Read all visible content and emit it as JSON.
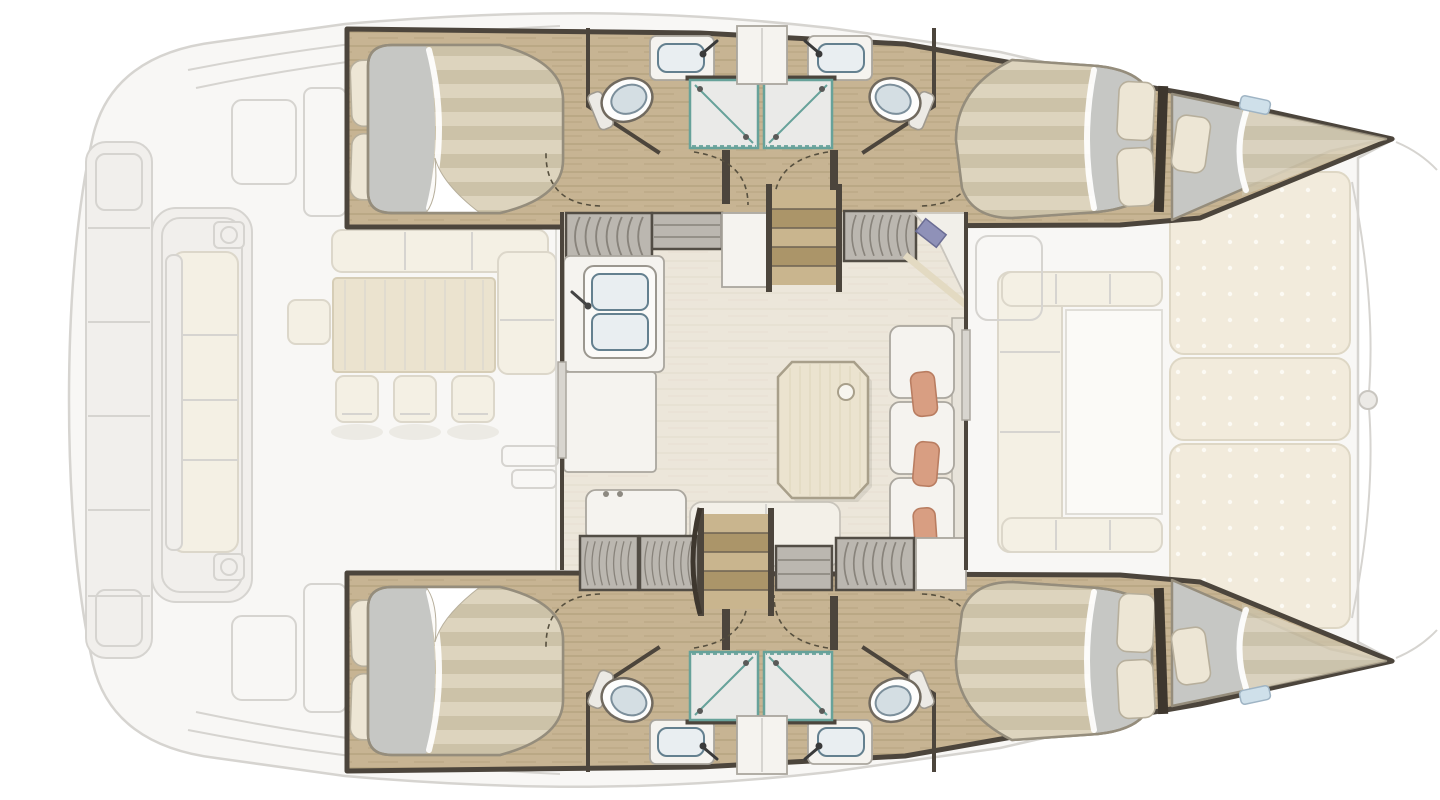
{
  "page": {
    "title": "Catamaran accommodation layout plan (top-down view)",
    "background": "#ffffff"
  },
  "diagram": {
    "type": "floor-plan",
    "subject": "sailing catamaran, deck and accommodation plan",
    "zones": {
      "aft_cockpit": {
        "label": "aft cockpit",
        "items": [
          "transom bench with cushions",
          "L-shaped bench",
          "dining table",
          "4 chairs",
          "swim platform"
        ]
      },
      "saloon": {
        "label": "saloon and galley",
        "items": [
          "double galley sink with faucet",
          "galley counter",
          "appliance unit",
          "chart table with plotter screen",
          "saloon table with cup recess",
          "L-shaped sofa with 3 salmon cushions",
          "bench seat",
          "hanging lockers",
          "companionway stairs to each hull"
        ]
      },
      "starboard_hull": {
        "label": "upper hull",
        "items": [
          "aft double cabin with 2 pillows",
          "toilet",
          "washbasin with faucet",
          "2 shower cabins",
          "forward double cabin with 2 pillows",
          "forepeak berth with pillow",
          "door swing arcs"
        ]
      },
      "port_hull": {
        "label": "lower hull (mirror of upper hull)",
        "items": [
          "aft double cabin with 2 pillows",
          "toilet",
          "washbasin with faucet",
          "2 shower cabins",
          "forward double cabin with 2 pillows",
          "forepeak berth with pillow",
          "door swing arcs"
        ]
      },
      "foredeck": {
        "label": "foredeck",
        "items": [
          "U-shaped forward cockpit seating",
          "3 sunpad cushions with button dots",
          "bow crossbeam fitting"
        ]
      }
    }
  },
  "colors": {
    "ext_fill": "#f8f7f5",
    "ext_fill2": "#f1efec",
    "ext_line": "#d6d4d0",
    "cream": "#f4f0e4",
    "cream_line": "#dcd7ca",
    "pad": "#f2ebdc",
    "pad_line": "#ded7c5",
    "pad_dot": "#fcfaf4",
    "table_wood": "#ebe3cf",
    "table_line": "#d6cdb6",
    "hull_wood": "#c7b493",
    "hull_streak": "#b29f7b",
    "saloon_floor": "#ece6da",
    "saloon_streak": "#e1dac9",
    "wall": "#4c453c",
    "wall_mid": "#706759",
    "locker_face": "#bbb7b0",
    "locker_dark": "#524d45",
    "locker_curve": "#88837b",
    "step_a": "#c9b58e",
    "step_b": "#ab9569",
    "stripe_a": "#ddd4be",
    "stripe_b": "#ccc2a8",
    "sheet_gray": "#c6c7c4",
    "mattress_line": "#958d7c",
    "pillow": "#ede6d5",
    "pillow_line": "#b7af9c",
    "white": "#f5f3ef",
    "white_line": "#aaa69e",
    "basin": "#e9eef1",
    "basin_line": "#64808f",
    "toilet_lid": "#d4dee3",
    "toilet_line": "#7c8f9b",
    "shower_floor": "#eaeae8",
    "teal": "#67a29a",
    "salmon": "#d89e82",
    "salmon_line": "#b97d61",
    "dash": "#57503f",
    "screen": "#8f91b8",
    "door_panel": "#d8d5cf",
    "window_blue": "#cfe0ea"
  }
}
